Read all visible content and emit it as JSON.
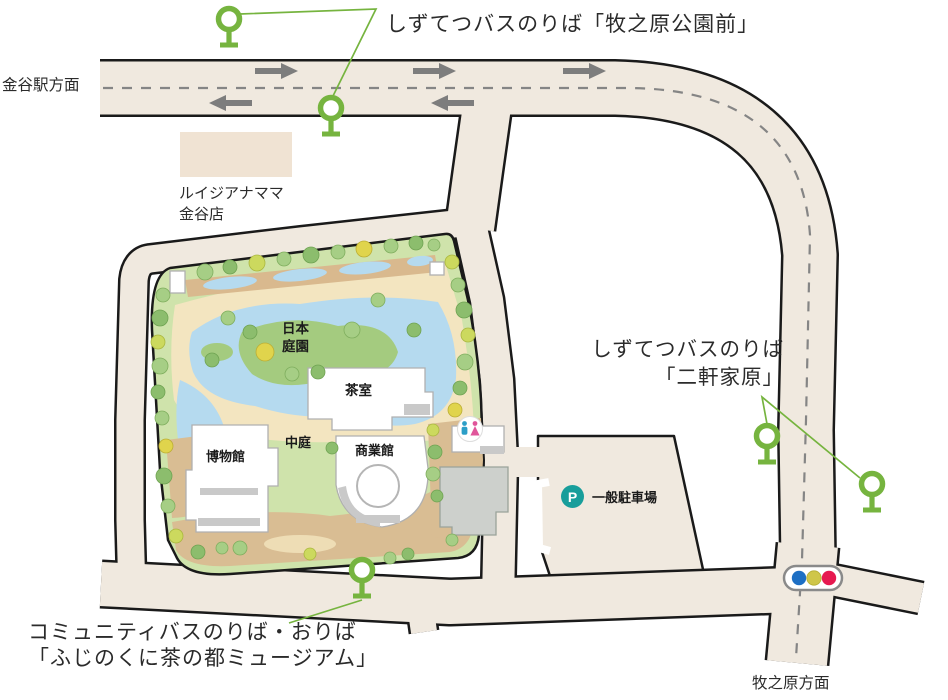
{
  "map_title": "ふじのくに茶の都ミュージアム 周辺案内図",
  "labels": {
    "kanaya_direction": "金谷駅方面",
    "stop_makinohara_park": "しずてつバスのりば「牧之原公園前」",
    "louisiana_mama": "ルイジアナママ\n金谷店",
    "stop_nikenyahara": "しずてつバスのりば\n「二軒家原」",
    "community_stop": "コミュニティバスのりば・おりば\n「ふじのくに茶の都ミュージアム」",
    "makinohara_direction": "牧之原方面",
    "parking": "一般駐車場",
    "parking_p": "P",
    "japanese_garden": "日本庭園",
    "tea_room": "茶室",
    "museum": "博物館",
    "courtyard": "中庭",
    "commercial_hall": "商業館"
  },
  "icons": {
    "bus_stop": "bus-stop-pole",
    "parking": "P-circle",
    "traffic_light": "blue-yellow-red",
    "restroom": "male-female-figures",
    "lane_arrows": "gray-directional-arrows"
  },
  "colors": {
    "road": "#f0e9df",
    "outline": "#1a1a1a",
    "dash": "#858585",
    "arrow": "#7d7d7d",
    "site": "#cfe3ab",
    "pond": "#b5daef",
    "sand": "#f3e5c0",
    "band": "#d9b98e",
    "tan": "#d9bd93",
    "sand2": "#eeddb5",
    "tree1": "#8cbd6d",
    "tree2": "#a6ce85",
    "tree3": "#ccd95e",
    "tree4": "#e0d44c",
    "bldg": "#ffffff",
    "bldggray": "#c9c9c9",
    "graybldg": "#cdd0cc",
    "bldgstroke": "#b0b0b0",
    "shop": "#f0e3d3",
    "bus": "#76b43f",
    "teal": "#189e9b",
    "tblue": "#1d6fc4",
    "tyellow": "#cfc649",
    "tred": "#e61950",
    "text": "#2b2b2b"
  }
}
